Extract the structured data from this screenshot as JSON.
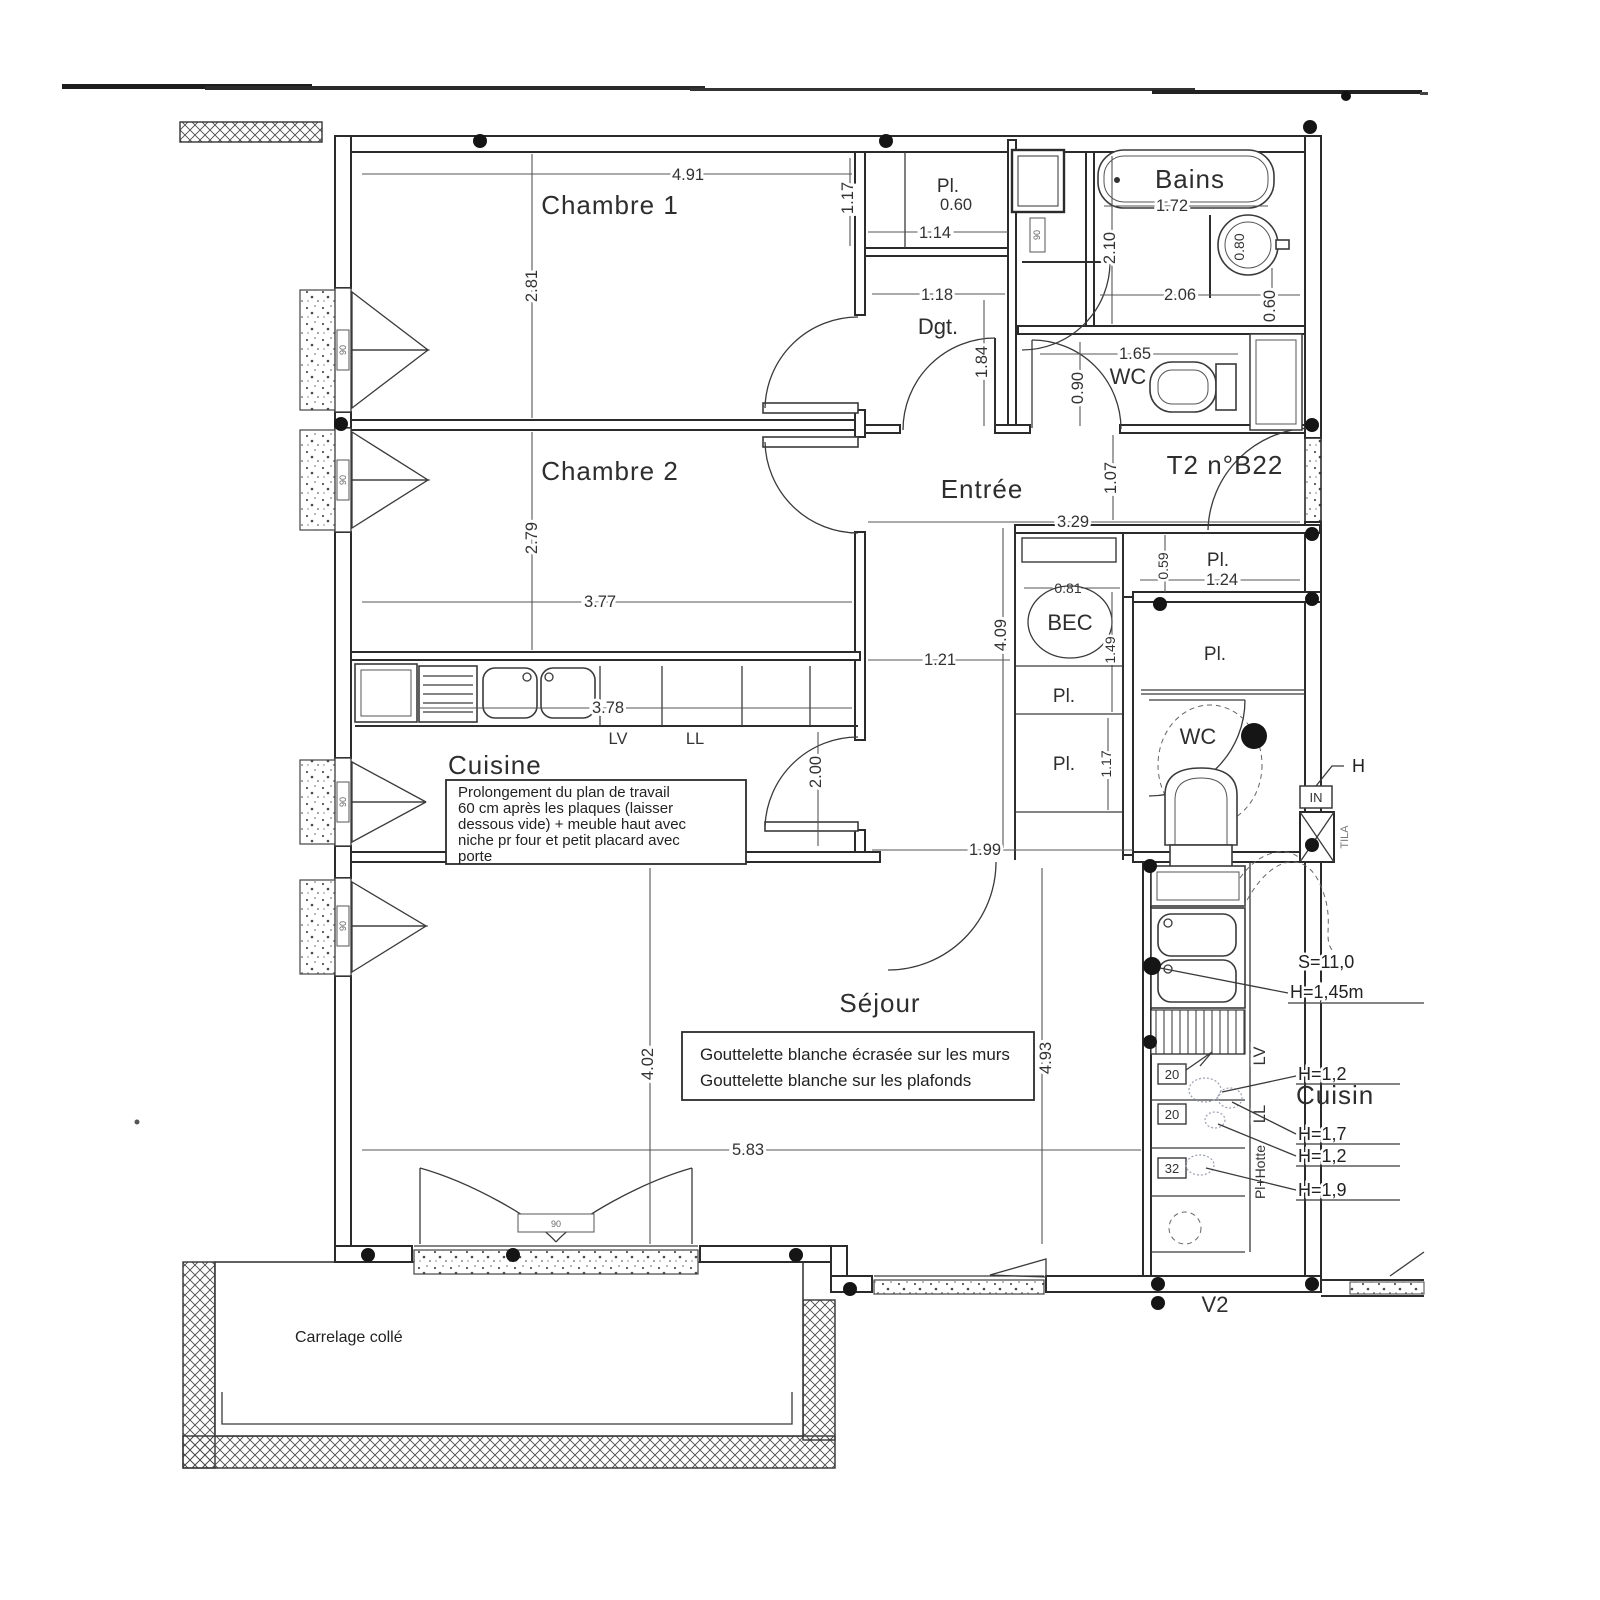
{
  "rooms": {
    "chambre1": {
      "label": "Chambre 1",
      "width": "4.91",
      "height": "2.81"
    },
    "chambre2": {
      "label": "Chambre 2",
      "width": "3.77",
      "height": "2.79"
    },
    "cuisine": {
      "label": "Cuisine",
      "counter_length": "3.78",
      "door_width": "2.00",
      "lv": "LV",
      "ll": "LL",
      "note": [
        "Prolongement du plan de travail",
        "60 cm après les plaques (laisser",
        "dessous vide) + meuble haut avec",
        "niche pr four et petit placard avec",
        "porte"
      ]
    },
    "sejour": {
      "label": "Séjour",
      "width": "5.83",
      "height_left": "4.02",
      "height_right": "4.93",
      "opening": "1.99",
      "note": [
        "Gouttelette blanche écrasée sur les murs",
        "Gouttelette blanche sur les plafonds"
      ]
    },
    "entree": {
      "label": "Entrée",
      "width": "3.29",
      "offset": "1.07",
      "length": "4.09",
      "passage": "1.21"
    },
    "dgt": {
      "label": "Dgt.",
      "width": "1.18",
      "height": "1.84",
      "corridor_width": "1.17"
    },
    "bains": {
      "label": "Bains",
      "bath_length": "1.72",
      "basin_diameter": "0.80",
      "room_height": "2.10",
      "width": "2.06",
      "side": "0.60"
    },
    "wc_top": {
      "label": "WC",
      "width": "1.65",
      "height": "0.90"
    },
    "wc_right": {
      "label": "WC"
    },
    "closets": {
      "pl_top": {
        "label": "Pl.",
        "depth": "0.60",
        "width": "1.14"
      },
      "pl_entree": {
        "label": "Pl.",
        "width": "1.24",
        "depth": "0.59"
      },
      "pl_col_upper": {
        "label": "Pl."
      },
      "pl_col_lower": {
        "label": "Pl.",
        "height": "1.17"
      },
      "pl_wc": {
        "label": "Pl."
      },
      "bec": {
        "label": "BEC",
        "width": "0.81",
        "height": "1.49"
      }
    },
    "kitchen_right": {
      "label": "Cuisin",
      "surface": "S=11,0",
      "worktop_height": "H=1,45m",
      "lv": "LV",
      "ll": "LL",
      "hood": "Pl+Hotte",
      "tags": [
        "20",
        "20",
        "32"
      ],
      "heights": [
        "H=1,2",
        "H=1,7",
        "H=1,2",
        "H=1,9"
      ],
      "in_box": "IN",
      "h_fragment": "H",
      "duct_fragment": "TILA"
    },
    "balcony": {
      "label": "Carrelage collé"
    }
  },
  "annotations": {
    "unit": "T2 n°B22",
    "window": "V2",
    "window_tag": "90"
  },
  "colors": {
    "ink": "#2b2b2b",
    "scan_gray": "#555555"
  }
}
